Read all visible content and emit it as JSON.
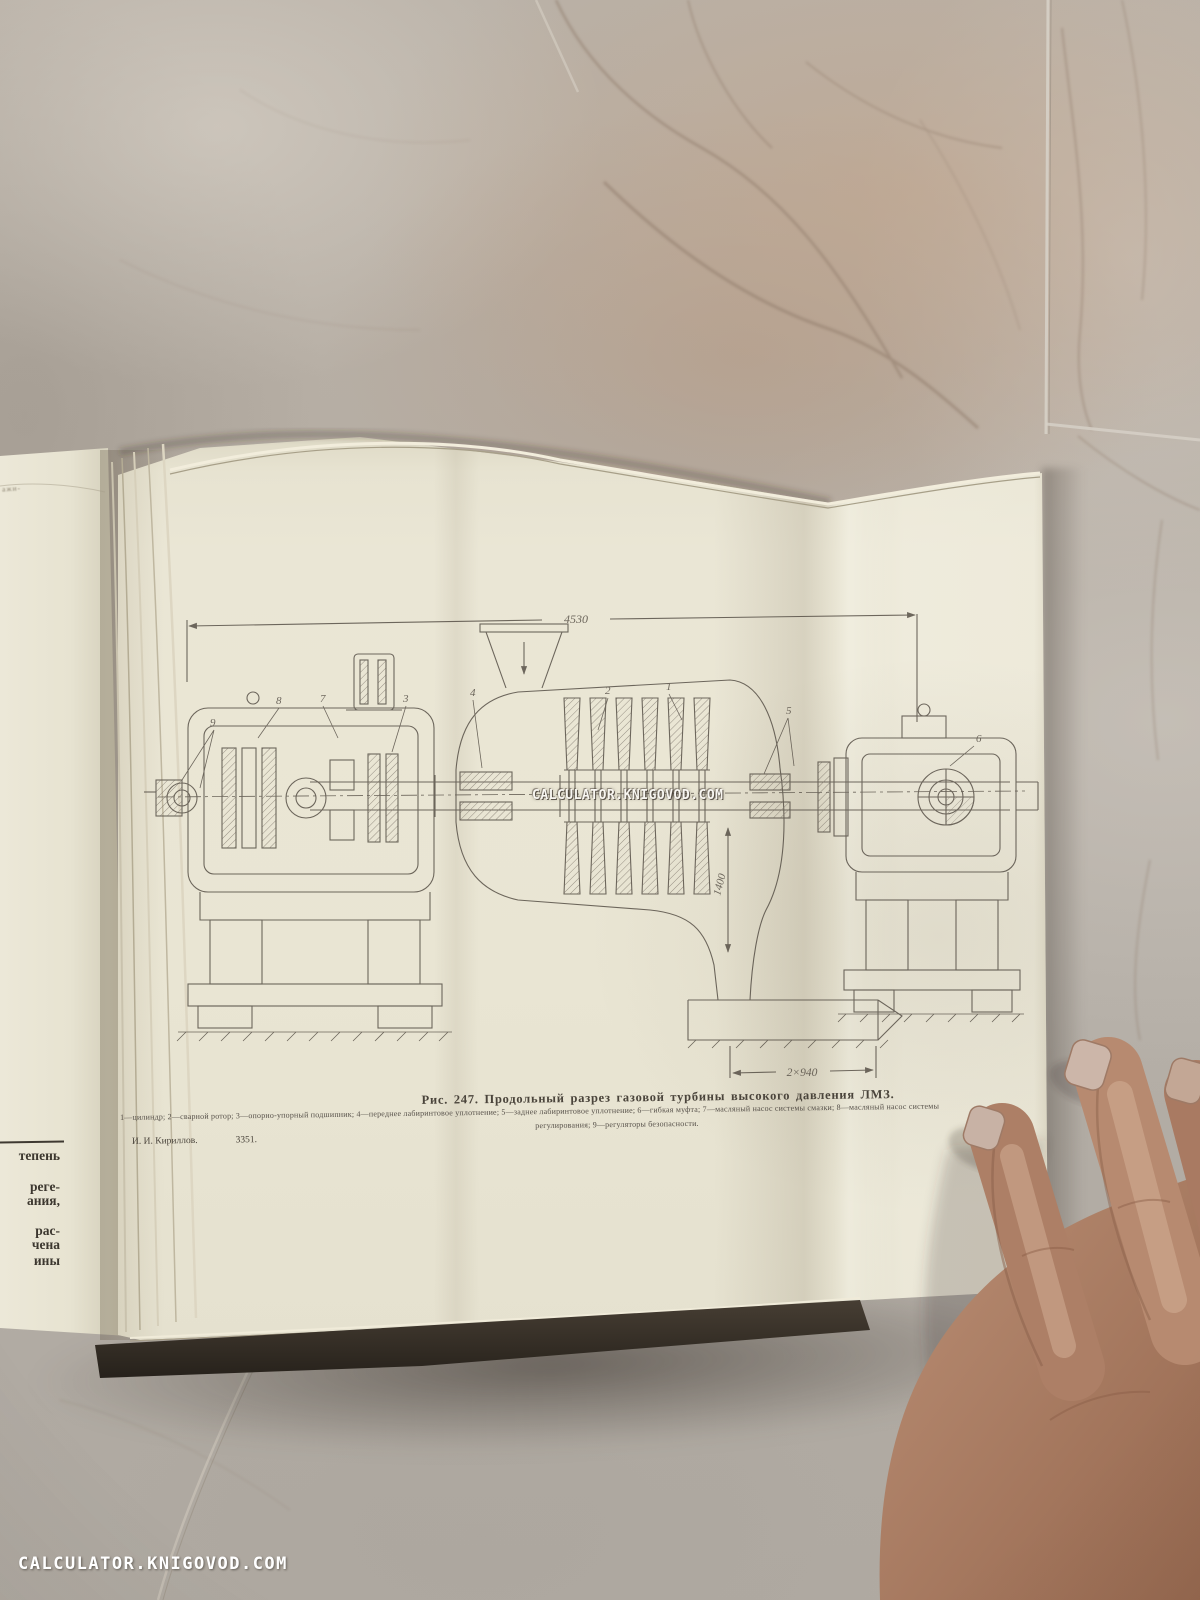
{
  "scene": {
    "page_color": "#e9e5d3",
    "ink_color": "#575047",
    "floor_color": "#b7afa5",
    "skin_color": "#b2836a"
  },
  "watermarks": {
    "center": "CALCULATOR.KNIGOVOD.COM",
    "bottom": "CALCULATOR.KNIGOVOD.COM"
  },
  "plate": {
    "caption": "Рис. 247. Продольный разрез газовой турбины высокого давления ЛМЗ.",
    "legend_line1": "1—цилиндр; 2—сварной ротор; 3—опорно-упорный подшипник; 4—переднее лабиринтовое уплотнение; 5—заднее лабиринтовое уплотнение; 6—гибкая муфта; 7—масляный насос системы смазки; 8—масляный насос системы",
    "legend_line2": "регулирования; 9—регуляторы безопасности.",
    "author": "И. И. Кириллов.",
    "print_code": "3351.",
    "dim_top": "4530",
    "dim_vertical": "1400",
    "dim_bottom": "2×940",
    "part_labels": [
      "1",
      "2",
      "3",
      "4",
      "5",
      "6",
      "7",
      "8",
      "9"
    ]
  },
  "left_page": {
    "top_fragment": "ажи-",
    "fragments": [
      "тепень",
      "реге-",
      "ания,",
      "рас-",
      "чена",
      "ины"
    ]
  }
}
